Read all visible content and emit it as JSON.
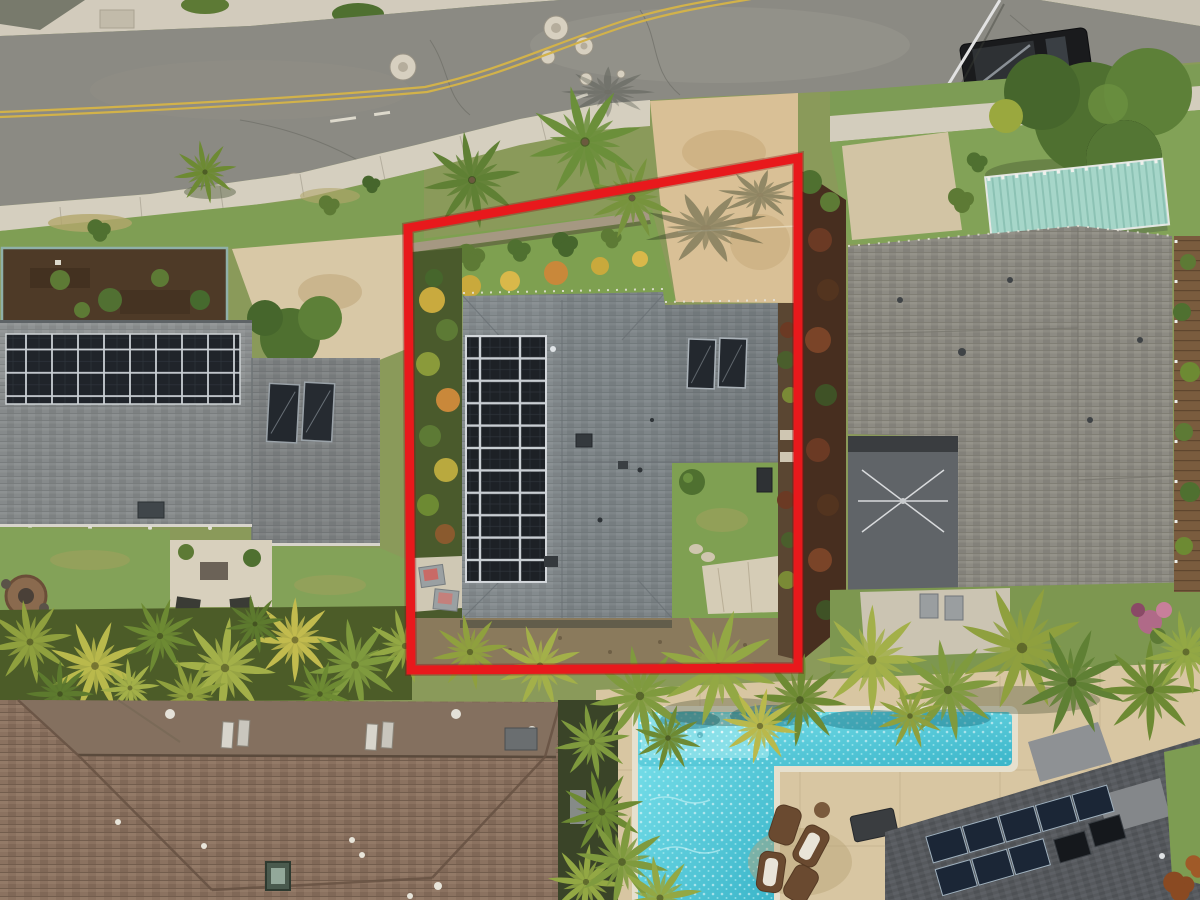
{
  "scene": {
    "description": "Aerial drone photo of a residential lot outlined in red: a gray-shingle house with a 2x11 rooftop solar array and two solar water heaters, tropical landscaping, a street with double yellow centerline above, neighboring homes on both sides, and an L-shaped swimming pool with lounge chairs below.",
    "boundary": {
      "shape": "quadrilateral",
      "color": "#e8191c"
    },
    "subject_house": {
      "solar_panel_columns": 2,
      "solar_panel_rows": 11,
      "solar_water_heaters": 2,
      "courtyard": "lawn with patio and bush"
    },
    "left_house": {
      "solar_panel_rows": 3,
      "solar_panel_columns": 9,
      "solar_water_heaters": 2,
      "garden_bed": "dark soil, teal border"
    },
    "right_house": {
      "laundry_patio": true,
      "pergola": "teal slatted canopy"
    },
    "bottom_left_house": {
      "roof": "brown hip roof with vents and skylight"
    },
    "bottom_right_house": {
      "solar_panels_row1": 5,
      "solar_panels_row2": 3,
      "solar_water_heaters": 2
    },
    "street": {
      "centerline": "double yellow",
      "manhole_covers": 7,
      "parked_vehicles": 1,
      "crosswalk_stripes": 3,
      "flagpole": 1
    },
    "pool": {
      "shape": "L-shaped",
      "lounge_chairs": 4,
      "tanning_shelf": true
    }
  },
  "colors": {
    "boundary": "#e8191c",
    "road": "#8b8a83",
    "sidewalk": "#d5cfbf",
    "grass": "#7f9e54",
    "subject_roof": "#7e8588",
    "left_roof": "#868a8b",
    "right_roof": "#8d8b83",
    "brown_roof": "#8b7260",
    "dark_roof": "#56595d",
    "solar_panel": "#1d2126",
    "water_heater": "#23282e",
    "driveway": "#d9c096",
    "deck": "#d8c6a2",
    "pool_light": "#7ce2ec",
    "pool_deep": "#3ab5c9",
    "pergola": "#a6d6c9",
    "yellow_line": "#d2b24a",
    "hedge_dark": "#472e1f",
    "soil": "#4e3a27",
    "truck": "#1a1b1d",
    "palm_green": "#7f9a3e"
  }
}
